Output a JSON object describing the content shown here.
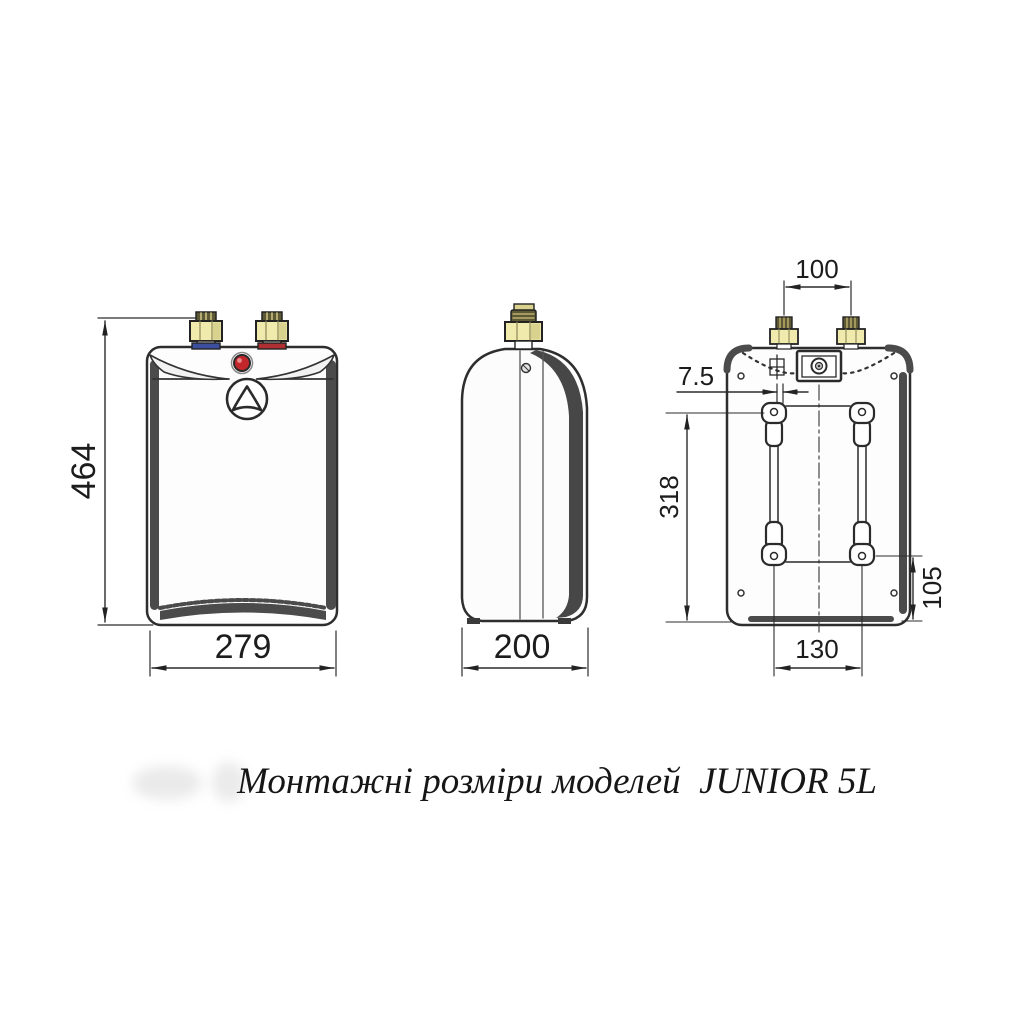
{
  "caption": "Монтажні розміри моделей  JUNIOR 5L",
  "model": "JUNIOR 5L",
  "dimensions": {
    "overall_height": "464",
    "overall_width": "279",
    "overall_depth": "200",
    "pipe_spacing": "100",
    "slot_offset": "7.5",
    "mount_height": "318",
    "mount_bottom_offset": "105",
    "mount_spacing": "130"
  },
  "colors": {
    "line": "#2c2c2c",
    "shade": "#4b4b4b",
    "brass": "#f0ebad",
    "brass_dark": "#5e5935",
    "cold_band": "#3c4f9e",
    "hot_band": "#ae3032",
    "indicator": "#c3272b",
    "background": "#ffffff"
  }
}
